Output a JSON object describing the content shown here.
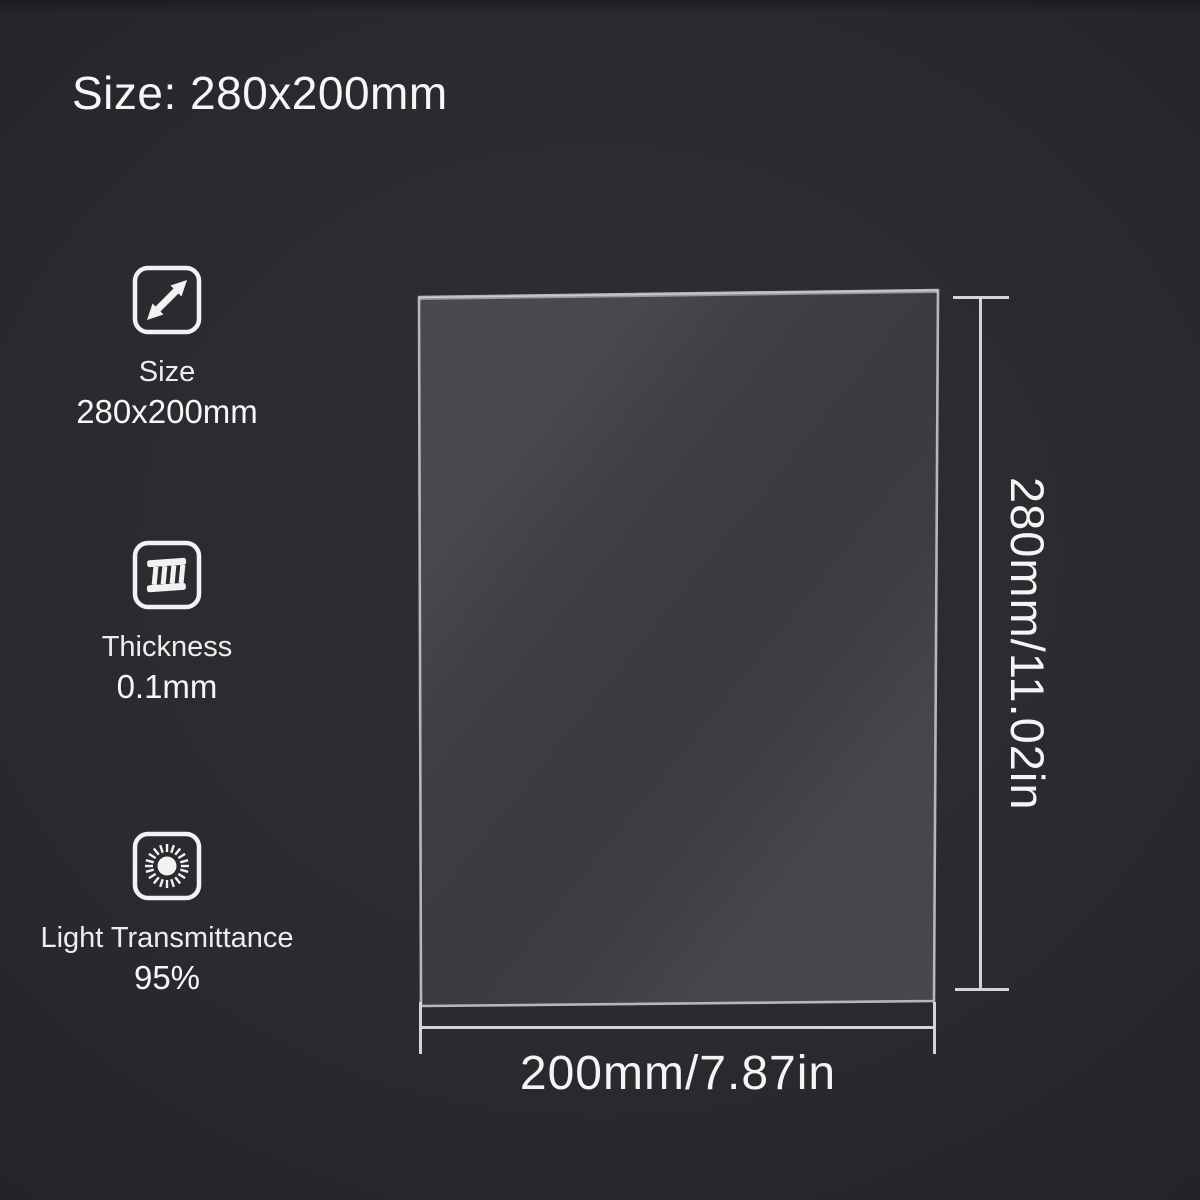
{
  "header": {
    "title": "Size: 280x200mm"
  },
  "specs": [
    {
      "icon": "resize-diagonal-icon",
      "label": "Size",
      "value": "280x200mm"
    },
    {
      "icon": "thickness-icon",
      "label": "Thickness",
      "value": "0.1mm"
    },
    {
      "icon": "light-transmittance-icon",
      "label": "Light Transmittance",
      "value": "95%"
    }
  ],
  "sheet": {
    "name": "transparent film sheet",
    "height_label": "280mm/11.02in",
    "width_label": "200mm/7.87in"
  },
  "colors": {
    "background": "#2b2a2f",
    "text": "#f4f4f5",
    "dimension_line": "#d4d4d7",
    "sheet_border": "#b7b7bb",
    "sheet_light": "#4a4950",
    "sheet_dark": "#3b3a40"
  }
}
